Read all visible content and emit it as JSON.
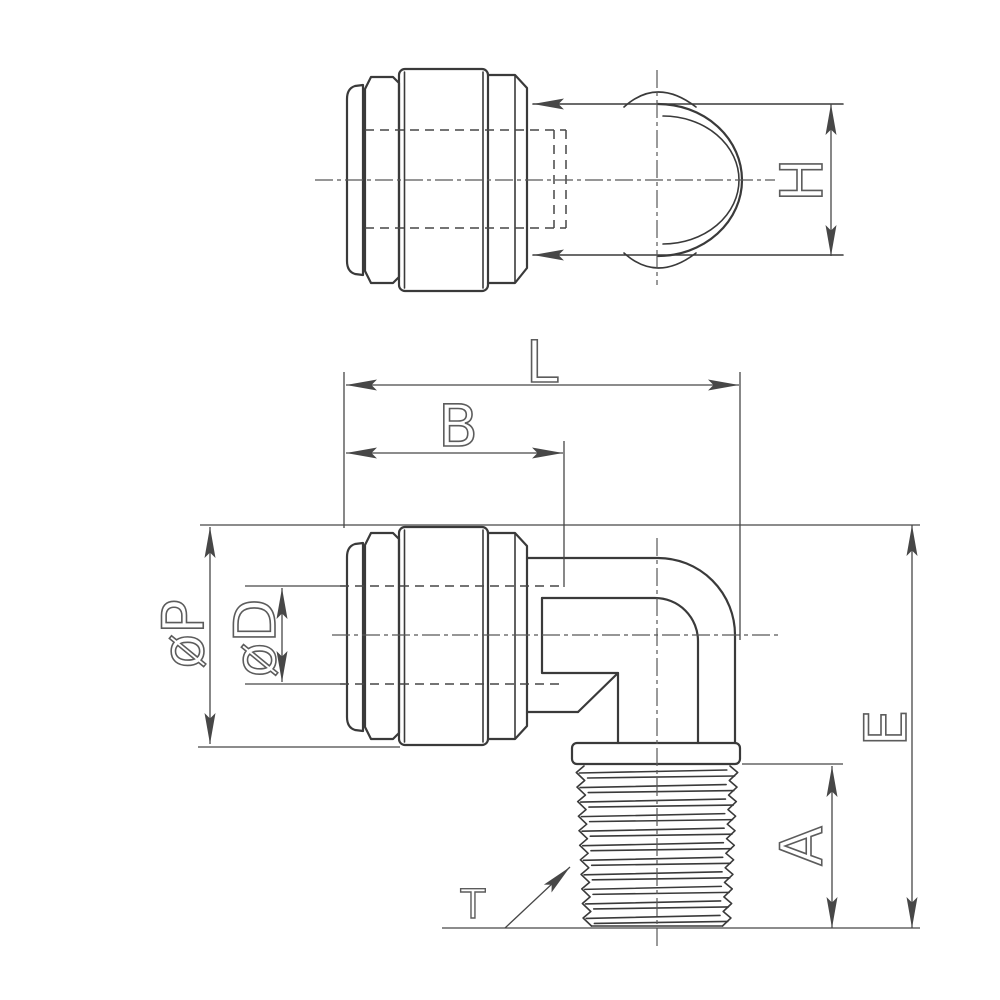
{
  "drawing": {
    "kind": "engineering-dimension-drawing",
    "part": "90-degree elbow push-in fitting with male taper thread"
  },
  "labels": {
    "h": "H",
    "l": "L",
    "b": "B",
    "p": "øP",
    "d": "øD",
    "e": "E",
    "a": "A",
    "t": "T"
  },
  "colors": {
    "line": "#3a3a3a",
    "dim": "#474747",
    "text": "#5c5c5c",
    "background": "#ffffff"
  }
}
